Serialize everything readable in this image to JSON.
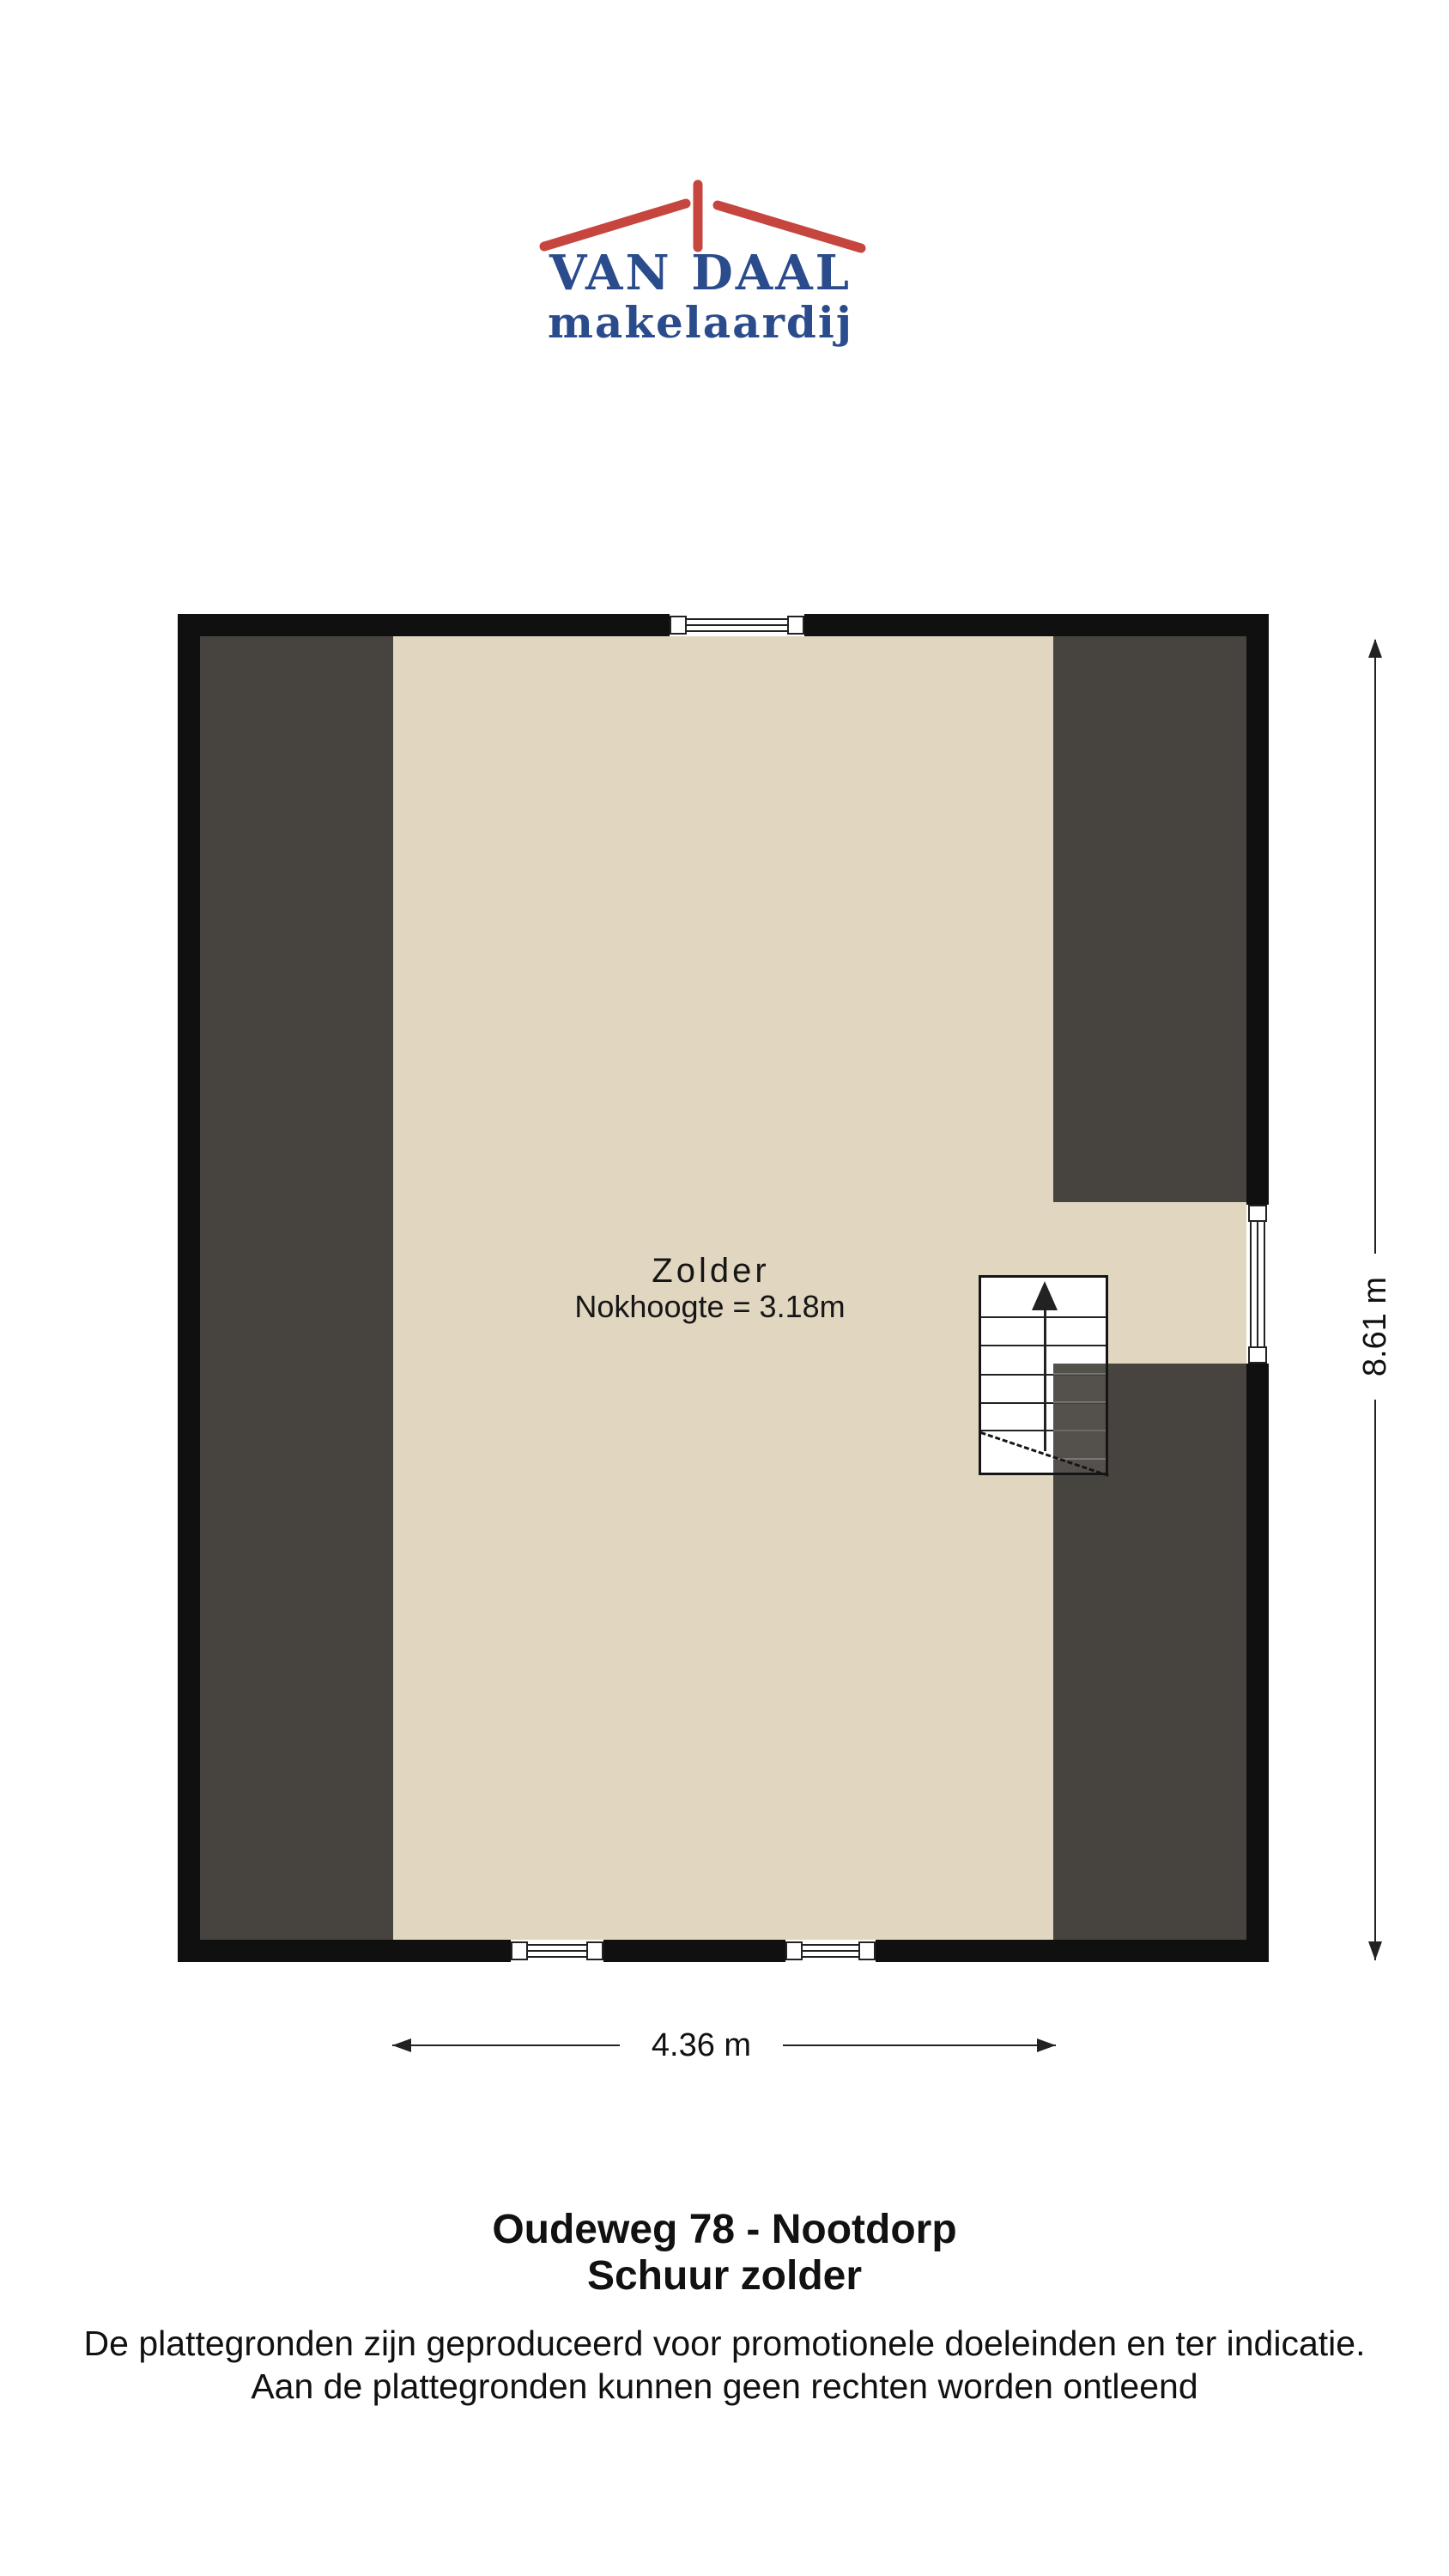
{
  "colors": {
    "wall": "#101010",
    "floor": "#e1d6c0",
    "slope": "#47443f",
    "line": "#1a1a1a",
    "logo_red": "#c6453e",
    "logo_blue": "#2a4c8c",
    "text": "#111111",
    "paper": "#ffffff"
  },
  "logo": {
    "name": "VAN DAAL",
    "subtitle": "makelaardij",
    "roof_icon": "red-roof-outline"
  },
  "floorplan": {
    "room_label": "Zolder",
    "ridge_height_label": "Nokhoogte = 3.18m",
    "width_dimension": "4.36 m",
    "height_dimension": "8.61 m",
    "stair_icon": "stairs-with-up-arrow"
  },
  "footer": {
    "address": "Oudeweg 78 - Nootdorp",
    "floor_name": "Schuur zolder",
    "disclaimer_line1": "De plattegronden zijn geproduceerd voor promotionele doeleinden en ter indicatie.",
    "disclaimer_line2": "Aan de plattegronden kunnen geen rechten worden ontleend"
  }
}
